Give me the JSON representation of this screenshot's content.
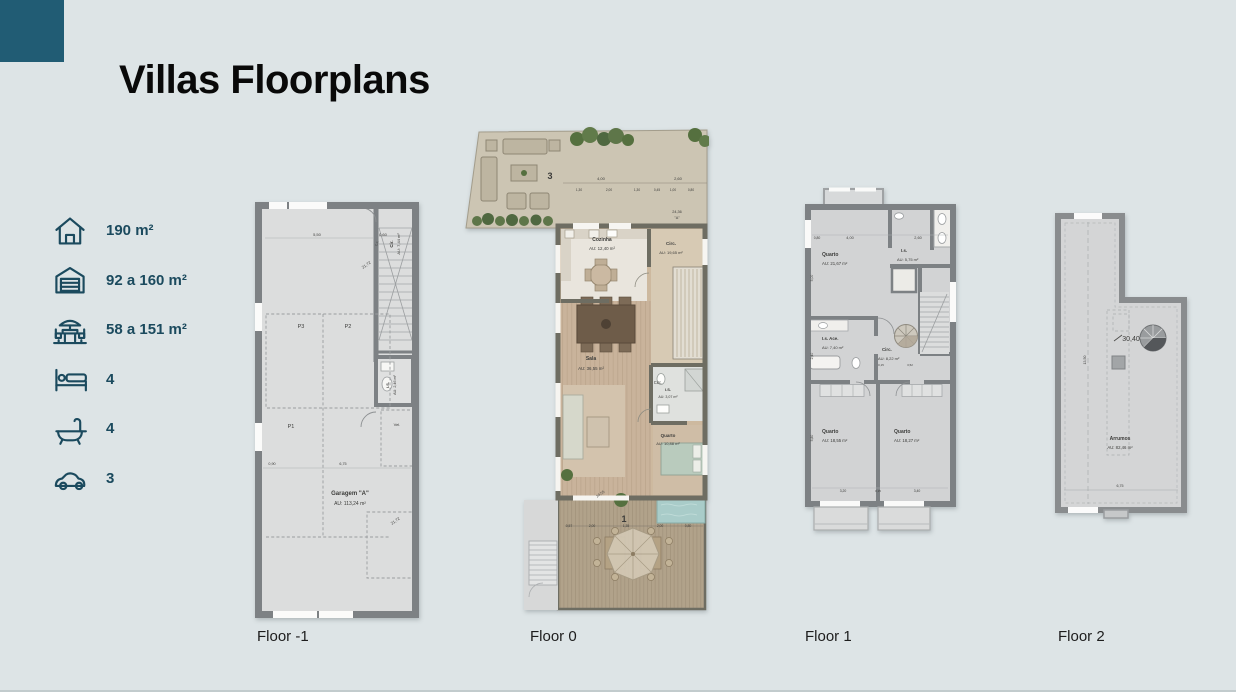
{
  "header": {
    "title": "Villas Floorplans"
  },
  "colors": {
    "accent_teal": "#215c74",
    "legend_ink": "#1b4a5e",
    "wall_gray": "#7d8184",
    "wood": "#c8b29a",
    "page_bg": "#dde4e6"
  },
  "legend": {
    "items": [
      {
        "id": "house",
        "label": "190 m²"
      },
      {
        "id": "garage",
        "label": "92 a 160 m²"
      },
      {
        "id": "terrace",
        "label": "58 a 151 m²"
      },
      {
        "id": "bedrooms",
        "label": "4"
      },
      {
        "id": "bathrooms",
        "label": "4"
      },
      {
        "id": "parking",
        "label": "3"
      }
    ]
  },
  "floors": {
    "fm1": {
      "caption": "Floor -1",
      "labels": [
        {
          "t": "5,50",
          "x": 62,
          "y": 34,
          "s": 4
        },
        {
          "t": "0,60",
          "x": 128,
          "y": 34,
          "s": 4
        },
        {
          "t": "C.F.",
          "x": 123,
          "y": 42,
          "s": 3,
          "r": -65
        },
        {
          "t": "21,72",
          "x": 112,
          "y": 64,
          "s": 4,
          "r": -35
        },
        {
          "t": "Cir.",
          "x": 138,
          "y": 42,
          "s": 4.5,
          "b": 1,
          "r": -90
        },
        {
          "t": "AU: 7,44 m²",
          "x": 145,
          "y": 42,
          "s": 4,
          "r": -90
        },
        {
          "t": "P3",
          "x": 46,
          "y": 126,
          "s": 5.5
        },
        {
          "t": "P2",
          "x": 93,
          "y": 126,
          "s": 5.5
        },
        {
          "t": "P1",
          "x": 36,
          "y": 226,
          "s": 5.5
        },
        {
          "t": "I.S.",
          "x": 134,
          "y": 183,
          "s": 4,
          "b": 1,
          "r": -90
        },
        {
          "t": "AU: 2,46 m²",
          "x": 141,
          "y": 183,
          "s": 3.7,
          "r": -90
        },
        {
          "t": "Vel.",
          "x": 142,
          "y": 224,
          "s": 4
        },
        {
          "t": "0,90",
          "x": 17,
          "y": 263,
          "s": 3.7
        },
        {
          "t": "6,75",
          "x": 88,
          "y": 263,
          "s": 3.7
        },
        {
          "t": "Garagem \"A\"",
          "x": 95,
          "y": 293,
          "s": 6,
          "b": 1
        },
        {
          "t": "AU: 113,24 m²",
          "x": 95,
          "y": 303,
          "s": 5
        },
        {
          "t": "21,72",
          "x": 141,
          "y": 320,
          "s": 4,
          "r": -35
        }
      ]
    },
    "f0": {
      "caption": "Floor 0",
      "labels": [
        {
          "t": "3",
          "x": 89,
          "y": 52,
          "s": 9,
          "b": 1
        },
        {
          "t": "4,00",
          "x": 140,
          "y": 53,
          "s": 4
        },
        {
          "t": "2,60",
          "x": 217,
          "y": 53,
          "s": 4
        },
        {
          "t": "1,30",
          "x": 118,
          "y": 64,
          "s": 3.2
        },
        {
          "t": "2,00",
          "x": 148,
          "y": 64,
          "s": 3.2
        },
        {
          "t": "1,30",
          "x": 176,
          "y": 64,
          "s": 3.2
        },
        {
          "t": "0,45",
          "x": 196,
          "y": 64,
          "s": 3.2
        },
        {
          "t": "1,00",
          "x": 212,
          "y": 64,
          "s": 3.2
        },
        {
          "t": "0,80",
          "x": 230,
          "y": 64,
          "s": 3.2
        },
        {
          "t": "24,36",
          "x": 216,
          "y": 86,
          "s": 3.8
        },
        {
          "t": "\"A\"",
          "x": 216,
          "y": 92,
          "s": 3.8
        },
        {
          "t": "Cozinha",
          "x": 141,
          "y": 114,
          "s": 5,
          "b": 1
        },
        {
          "t": "AU: 12,40 m²",
          "x": 141,
          "y": 123,
          "s": 4.4
        },
        {
          "t": "Circ.",
          "x": 210,
          "y": 118,
          "s": 4.5,
          "b": 1
        },
        {
          "t": "AU: 19,65 m²",
          "x": 210,
          "y": 127,
          "s": 4
        },
        {
          "t": "Sala",
          "x": 130,
          "y": 233,
          "s": 5,
          "b": 1
        },
        {
          "t": "AU: 36,55 m²",
          "x": 130,
          "y": 243,
          "s": 4.4
        },
        {
          "t": "Circ.",
          "x": 197,
          "y": 257,
          "s": 4.2
        },
        {
          "t": "I.S.",
          "x": 207,
          "y": 264,
          "s": 4,
          "b": 1
        },
        {
          "t": "AU: 3,07 m²",
          "x": 207,
          "y": 271,
          "s": 3.6
        },
        {
          "t": "Quarto",
          "x": 207,
          "y": 310,
          "s": 4.5,
          "b": 1
        },
        {
          "t": "AU: 10,88 m²",
          "x": 207,
          "y": 318,
          "s": 4
        },
        {
          "t": "24,55",
          "x": 140,
          "y": 368,
          "s": 3.8,
          "r": -35
        },
        {
          "t": "1",
          "x": 163,
          "y": 395,
          "s": 9,
          "b": 1
        },
        {
          "t": "0,57",
          "x": 108,
          "y": 400,
          "s": 3.4
        },
        {
          "t": "2,00",
          "x": 131,
          "y": 400,
          "s": 3.4
        },
        {
          "t": "1,35",
          "x": 165,
          "y": 400,
          "s": 3.4
        },
        {
          "t": "2,00",
          "x": 199,
          "y": 400,
          "s": 3.4
        },
        {
          "t": "0,80",
          "x": 227,
          "y": 400,
          "s": 3.4
        }
      ]
    },
    "f1": {
      "caption": "Floor 1",
      "labels": [
        {
          "t": "0,80",
          "x": 19,
          "y": 53,
          "s": 3.4
        },
        {
          "t": "4,00",
          "x": 52,
          "y": 53,
          "s": 3.8
        },
        {
          "t": "2,60",
          "x": 120,
          "y": 53,
          "s": 3.8
        },
        {
          "t": "Quarto",
          "x": 24,
          "y": 70,
          "s": 5,
          "b": 1,
          "a": "start"
        },
        {
          "t": "AU: 21,67 m²",
          "x": 24,
          "y": 79,
          "s": 4.3,
          "a": "start"
        },
        {
          "t": "I.s.",
          "x": 103,
          "y": 66,
          "s": 4.4,
          "b": 1,
          "a": "start"
        },
        {
          "t": "AU: 5,75 m²",
          "x": 99,
          "y": 75,
          "s": 4,
          "a": "start"
        },
        {
          "t": "5,00",
          "x": 15,
          "y": 92,
          "s": 3.4,
          "r": -90
        },
        {
          "t": "I.s. Ace.",
          "x": 24,
          "y": 154,
          "s": 4.4,
          "b": 1,
          "a": "start"
        },
        {
          "t": "AU: 7,40 m²",
          "x": 24,
          "y": 163,
          "s": 4,
          "a": "start"
        },
        {
          "t": "2,40",
          "x": 15,
          "y": 170,
          "s": 3.4,
          "r": -90
        },
        {
          "t": "Circ.",
          "x": 84,
          "y": 165,
          "s": 4.4,
          "b": 1,
          "a": "start"
        },
        {
          "t": "AU: 8,22 m²",
          "x": 80,
          "y": 174,
          "s": 4,
          "a": "start"
        },
        {
          "t": "0,15",
          "x": 83,
          "y": 180,
          "s": 2.9
        },
        {
          "t": "3,52",
          "x": 112,
          "y": 180,
          "s": 2.9
        },
        {
          "t": "Quarto",
          "x": 24,
          "y": 247,
          "s": 5,
          "b": 1,
          "a": "start"
        },
        {
          "t": "AU: 18,55 m²",
          "x": 24,
          "y": 256,
          "s": 4.3,
          "a": "start"
        },
        {
          "t": "Quarto",
          "x": 96,
          "y": 247,
          "s": 5,
          "b": 1,
          "a": "start"
        },
        {
          "t": "AU: 18,27 m²",
          "x": 96,
          "y": 256,
          "s": 4.3,
          "a": "start"
        },
        {
          "t": "5,80",
          "x": 15,
          "y": 252,
          "s": 3.4,
          "r": -90
        },
        {
          "t": "3,20",
          "x": 45,
          "y": 306,
          "s": 3.4
        },
        {
          "t": "0,15",
          "x": 80,
          "y": 306,
          "s": 2.9
        },
        {
          "t": "3,40",
          "x": 119,
          "y": 306,
          "s": 3.4
        }
      ]
    },
    "f2": {
      "caption": "Floor 2",
      "labels": [
        {
          "t": "30,40",
          "x": 81,
          "y": 131,
          "s": 7
        },
        {
          "t": "13,50",
          "x": 36,
          "y": 150,
          "s": 3.6,
          "r": -90
        },
        {
          "t": "Arrumos",
          "x": 70,
          "y": 230,
          "s": 5,
          "b": 1
        },
        {
          "t": "AU: 82,46 m²",
          "x": 70,
          "y": 239,
          "s": 4.3
        },
        {
          "t": "6,75",
          "x": 70,
          "y": 277,
          "s": 3.6
        }
      ]
    }
  }
}
